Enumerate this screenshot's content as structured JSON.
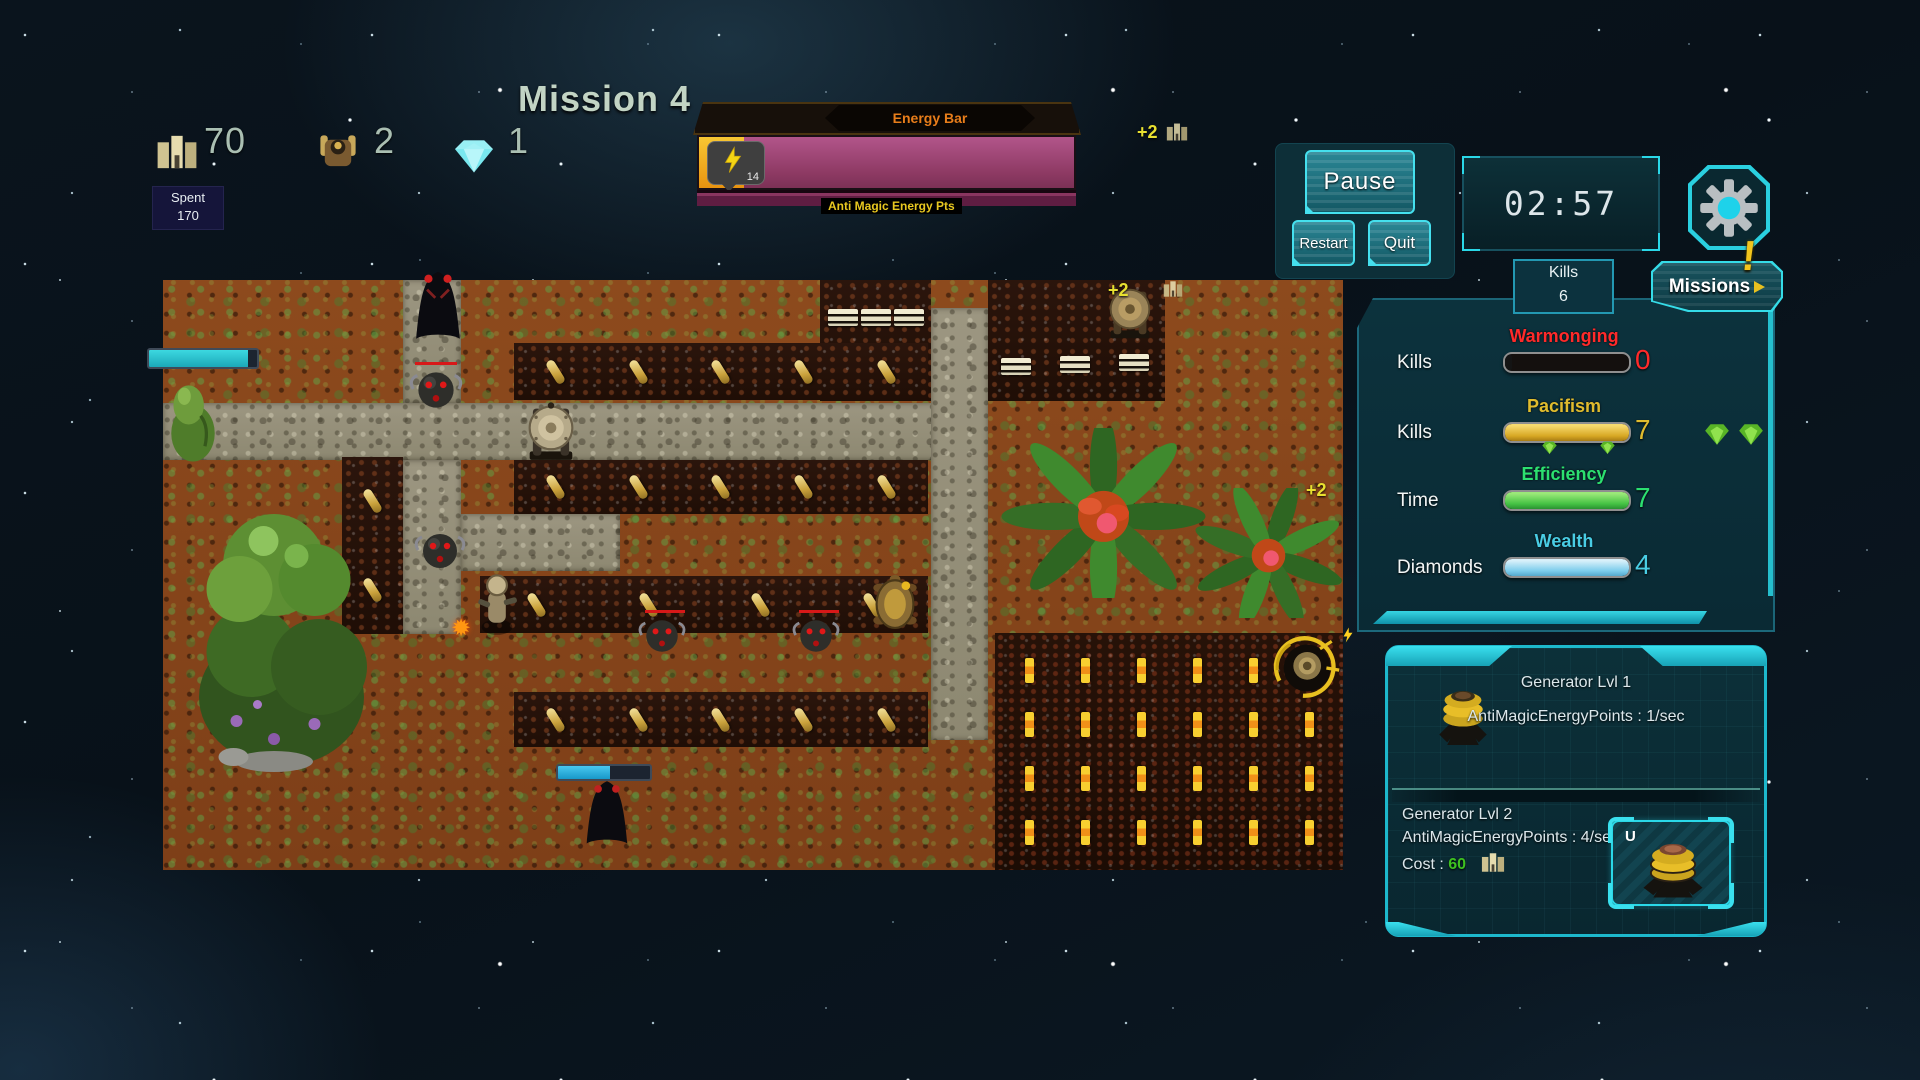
{
  "hud": {
    "mission_title": "Mission 4",
    "resources": [
      {
        "icon": "gold-icon",
        "value": "70"
      },
      {
        "icon": "unit-icon",
        "value": "2"
      },
      {
        "icon": "diamond-icon",
        "value": "1"
      }
    ],
    "spent": {
      "label": "Spent",
      "value": "170"
    },
    "energy": {
      "title": "Energy Bar",
      "tooltip_value": "14",
      "caption": "Anti Magic Energy Pts",
      "fill_percent": 12
    },
    "bonus": "+2",
    "pause_label": "Pause",
    "restart_label": "Restart",
    "quit_label": "Quit",
    "timer": "02:57",
    "alert_mark": "!",
    "kills_badge": {
      "label": "Kills",
      "value": "6"
    },
    "missions_label": "Missions"
  },
  "stats": {
    "rows": [
      {
        "row_label": "Kills",
        "title": "Warmonging",
        "value": "0",
        "color": "#ff2a2a",
        "fill_percent": 0
      },
      {
        "row_label": "Kills",
        "title": "Pacifism",
        "value": "7",
        "color": "#e0bc2e",
        "fill_percent": 100
      },
      {
        "row_label": "Time",
        "title": "Efficiency",
        "value": "7",
        "color": "#2ce070",
        "fill_percent": 100
      },
      {
        "row_label": "Diamonds",
        "title": "Wealth",
        "value": "4",
        "color": "#49cde4",
        "fill_percent": 100
      }
    ]
  },
  "generator": {
    "current_title": "Generator Lvl 1",
    "current_info": "AntiMagicEnergyPoints : 1/sec",
    "next_title": "Generator Lvl 2",
    "next_info": "AntiMagicEnergyPoints : 4/sec",
    "cost_label": "Cost :",
    "cost_value": "60",
    "upgrade_key": "U"
  },
  "map_overlay": {
    "bonus_a": "+2",
    "bonus_b": "+2"
  },
  "colors": {
    "accent_cyan": "#2ad8e8",
    "panel_bg": "#0b2e38",
    "energy_pink": "#9c4473",
    "energy_fill": "#f0a81c",
    "warmonging": "#ff2a2a",
    "pacifism": "#e0bc2e",
    "efficiency": "#2ce070",
    "wealth": "#49cde4",
    "bonus_yellow": "#e8e030"
  }
}
